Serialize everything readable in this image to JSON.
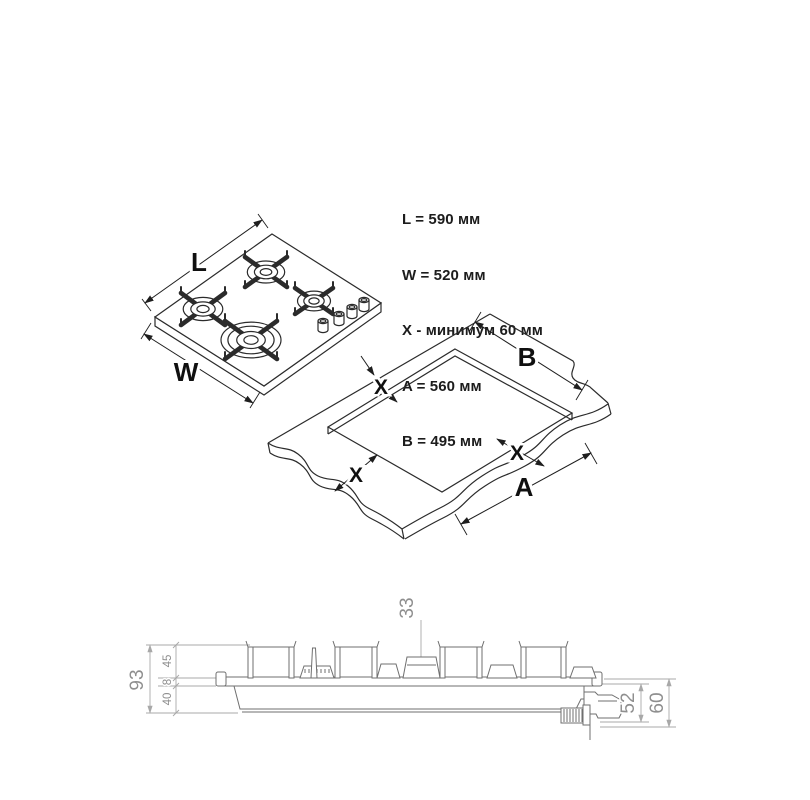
{
  "specs": {
    "lines": [
      "L = 590 мм",
      "W = 520 мм",
      "X - минимум 60 мм",
      "A = 560 мм",
      "B = 495 мм"
    ]
  },
  "hob_view": {
    "length_label": "L",
    "width_label": "W"
  },
  "cutout_view": {
    "width_label": "B",
    "length_label": "A",
    "clearance_top": "X",
    "clearance_left": "X",
    "clearance_right": "X"
  },
  "side_view": {
    "overall_height": "93",
    "support_height": "45",
    "glass_thickness": "8",
    "body_depth": "40",
    "cap_height": "33",
    "pipe_depth": "52",
    "total_depth": "60"
  },
  "colors": {
    "ink": "#2b2b2b",
    "elevation_line": "#6f6f6f",
    "dimension_gray": "#a8a8a8",
    "text_gray": "#8f8f8f",
    "text_dark": "#1c1c1c",
    "background": "#ffffff"
  }
}
